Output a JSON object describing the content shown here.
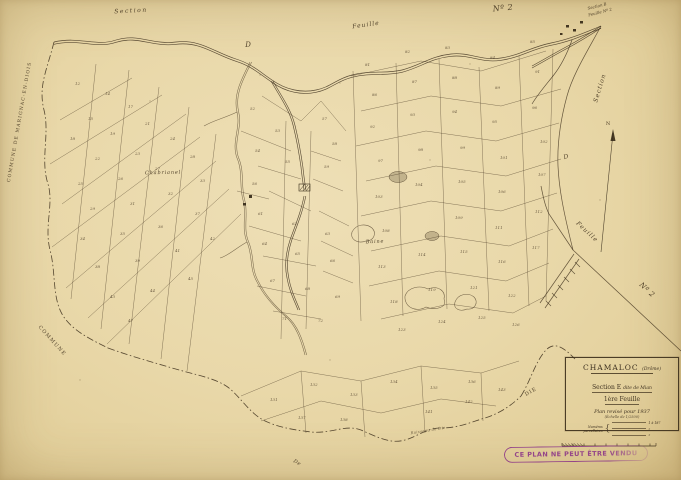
{
  "palette": {
    "paper": "#e9d8a9",
    "ink": "#43341f",
    "stamp": "#8e3a88"
  },
  "title_block": {
    "commune": "CHAMALOC",
    "departement": "(Drôme)",
    "section": "Section E",
    "section_sub": "dite de Mian",
    "sheet": "1ère Feuille",
    "revision": "Plan revisé pour 1937",
    "scale": "(Échelle de 1/2500)",
    "numbers_label_1": "Numéros",
    "numbers_label_2": "parcellaires",
    "numbers_range": "1 à 187"
  },
  "stamp_text": "CE PLAN NE PEUT ÊTRE VENDU",
  "labels": [
    {
      "name": "margin-label-section-top",
      "text": "Section",
      "x": 131,
      "y": 11,
      "rot": -3,
      "size": 6,
      "ls": 1.5,
      "it": 1
    },
    {
      "name": "margin-label-feuille-top",
      "text": "Feuille",
      "x": 366,
      "y": 25,
      "rot": -8,
      "size": 6,
      "ls": 1,
      "it": 1
    },
    {
      "name": "margin-label-d-top",
      "text": "D",
      "x": 248,
      "y": 45,
      "rot": 0,
      "size": 7,
      "ls": 0,
      "it": 1
    },
    {
      "name": "margin-label-no2-top",
      "text": "Nº 2",
      "x": 503,
      "y": 8,
      "rot": -5,
      "size": 8,
      "ls": 0.5,
      "it": 1
    },
    {
      "name": "corner-note-line1",
      "text": "Section B",
      "x": 597,
      "y": 6,
      "rot": -14,
      "size": 4,
      "ls": 0,
      "it": 1
    },
    {
      "name": "corner-note-line2",
      "text": "Feuille Nº 2",
      "x": 600,
      "y": 12,
      "rot": -14,
      "size": 4,
      "ls": 0,
      "it": 1
    },
    {
      "name": "margin-label-section-right",
      "text": "Section",
      "x": 600,
      "y": 88,
      "rot": -73,
      "size": 6,
      "ls": 1,
      "it": 1
    },
    {
      "name": "margin-label-d-right",
      "text": "D",
      "x": 566,
      "y": 157,
      "rot": -15,
      "size": 6,
      "ls": 0,
      "it": 1
    },
    {
      "name": "margin-label-feuille-right",
      "text": "Feuille",
      "x": 587,
      "y": 232,
      "rot": 43,
      "size": 6,
      "ls": 1,
      "it": 1
    },
    {
      "name": "margin-label-no2-right",
      "text": "Nº 2",
      "x": 647,
      "y": 290,
      "rot": 43,
      "size": 7,
      "ls": 0.5,
      "it": 1
    },
    {
      "name": "place-label-chabrianel",
      "text": "Chabrianel",
      "x": 163,
      "y": 173,
      "rot": -1,
      "size": 5,
      "ls": 0.8,
      "it": 1
    },
    {
      "name": "place-label-baine",
      "text": "Baine",
      "x": 375,
      "y": 242,
      "rot": -2,
      "size": 5,
      "ls": 0.8,
      "it": 1
    },
    {
      "name": "boundary-label-marignac",
      "text": "COMMUNE DE MARIGNAC-EN-DIOIS",
      "x": 20,
      "y": 122,
      "rot": -80,
      "size": 4.5,
      "ls": 1.2,
      "it": 0
    },
    {
      "name": "boundary-label-commune",
      "text": "COMMUNE",
      "x": 52,
      "y": 341,
      "rot": 48,
      "size": 5,
      "ls": 1.2,
      "it": 0
    },
    {
      "name": "boundary-label-de",
      "text": "De",
      "x": 297,
      "y": 463,
      "rot": 30,
      "size": 5,
      "ls": 0.5,
      "it": 1
    },
    {
      "name": "boundary-label-die",
      "text": "DIE",
      "x": 531,
      "y": 392,
      "rot": -30,
      "size": 5,
      "ls": 1,
      "it": 0
    },
    {
      "name": "stream-label",
      "text": "Ruisseau de Die",
      "x": 428,
      "y": 430,
      "rot": -9,
      "size": 3.8,
      "ls": 0.3,
      "it": 1,
      "op": 0.75
    },
    {
      "name": "north-arrow-label",
      "text": "N",
      "x": 608,
      "y": 124,
      "rot": 0,
      "size": 5,
      "ls": 0,
      "it": 0
    }
  ],
  "parcel_numbers": [
    {
      "x": 75,
      "y": 85,
      "t": "12"
    },
    {
      "x": 105,
      "y": 95,
      "t": "14"
    },
    {
      "x": 88,
      "y": 120,
      "t": "15"
    },
    {
      "x": 128,
      "y": 108,
      "t": "17"
    },
    {
      "x": 70,
      "y": 140,
      "t": "18"
    },
    {
      "x": 110,
      "y": 135,
      "t": "19"
    },
    {
      "x": 145,
      "y": 125,
      "t": "21"
    },
    {
      "x": 95,
      "y": 160,
      "t": "22"
    },
    {
      "x": 135,
      "y": 155,
      "t": "23"
    },
    {
      "x": 170,
      "y": 140,
      "t": "24"
    },
    {
      "x": 78,
      "y": 185,
      "t": "25"
    },
    {
      "x": 118,
      "y": 180,
      "t": "26"
    },
    {
      "x": 155,
      "y": 170,
      "t": "27"
    },
    {
      "x": 190,
      "y": 158,
      "t": "28"
    },
    {
      "x": 90,
      "y": 210,
      "t": "29"
    },
    {
      "x": 130,
      "y": 205,
      "t": "31"
    },
    {
      "x": 168,
      "y": 195,
      "t": "32"
    },
    {
      "x": 200,
      "y": 182,
      "t": "33"
    },
    {
      "x": 80,
      "y": 240,
      "t": "34"
    },
    {
      "x": 120,
      "y": 235,
      "t": "35"
    },
    {
      "x": 158,
      "y": 228,
      "t": "36"
    },
    {
      "x": 195,
      "y": 215,
      "t": "37"
    },
    {
      "x": 95,
      "y": 268,
      "t": "38"
    },
    {
      "x": 135,
      "y": 262,
      "t": "39"
    },
    {
      "x": 175,
      "y": 252,
      "t": "41"
    },
    {
      "x": 210,
      "y": 240,
      "t": "42"
    },
    {
      "x": 110,
      "y": 298,
      "t": "43"
    },
    {
      "x": 150,
      "y": 292,
      "t": "44"
    },
    {
      "x": 188,
      "y": 280,
      "t": "45"
    },
    {
      "x": 128,
      "y": 322,
      "t": "47"
    },
    {
      "x": 250,
      "y": 110,
      "t": "52"
    },
    {
      "x": 275,
      "y": 132,
      "t": "53"
    },
    {
      "x": 255,
      "y": 152,
      "t": "54"
    },
    {
      "x": 285,
      "y": 163,
      "t": "55"
    },
    {
      "x": 252,
      "y": 185,
      "t": "56"
    },
    {
      "x": 322,
      "y": 120,
      "t": "57"
    },
    {
      "x": 332,
      "y": 145,
      "t": "58"
    },
    {
      "x": 324,
      "y": 168,
      "t": "59"
    },
    {
      "x": 258,
      "y": 215,
      "t": "61"
    },
    {
      "x": 292,
      "y": 225,
      "t": "62"
    },
    {
      "x": 325,
      "y": 235,
      "t": "63"
    },
    {
      "x": 262,
      "y": 245,
      "t": "64"
    },
    {
      "x": 295,
      "y": 255,
      "t": "65"
    },
    {
      "x": 330,
      "y": 262,
      "t": "66"
    },
    {
      "x": 270,
      "y": 282,
      "t": "67"
    },
    {
      "x": 305,
      "y": 290,
      "t": "68"
    },
    {
      "x": 335,
      "y": 298,
      "t": "69"
    },
    {
      "x": 282,
      "y": 320,
      "t": "71"
    },
    {
      "x": 318,
      "y": 322,
      "t": "72"
    },
    {
      "x": 365,
      "y": 66,
      "t": "81"
    },
    {
      "x": 405,
      "y": 53,
      "t": "82"
    },
    {
      "x": 445,
      "y": 49,
      "t": "83"
    },
    {
      "x": 490,
      "y": 59,
      "t": "84"
    },
    {
      "x": 530,
      "y": 43,
      "t": "85"
    },
    {
      "x": 372,
      "y": 96,
      "t": "86"
    },
    {
      "x": 412,
      "y": 83,
      "t": "87"
    },
    {
      "x": 452,
      "y": 79,
      "t": "88"
    },
    {
      "x": 495,
      "y": 89,
      "t": "89"
    },
    {
      "x": 535,
      "y": 73,
      "t": "91"
    },
    {
      "x": 370,
      "y": 128,
      "t": "92"
    },
    {
      "x": 410,
      "y": 116,
      "t": "93"
    },
    {
      "x": 452,
      "y": 113,
      "t": "94"
    },
    {
      "x": 492,
      "y": 123,
      "t": "95"
    },
    {
      "x": 532,
      "y": 109,
      "t": "96"
    },
    {
      "x": 378,
      "y": 162,
      "t": "97"
    },
    {
      "x": 418,
      "y": 151,
      "t": "98"
    },
    {
      "x": 460,
      "y": 149,
      "t": "99"
    },
    {
      "x": 500,
      "y": 159,
      "t": "101"
    },
    {
      "x": 540,
      "y": 143,
      "t": "102"
    },
    {
      "x": 375,
      "y": 198,
      "t": "103"
    },
    {
      "x": 415,
      "y": 186,
      "t": "104"
    },
    {
      "x": 458,
      "y": 183,
      "t": "105"
    },
    {
      "x": 498,
      "y": 193,
      "t": "106"
    },
    {
      "x": 538,
      "y": 176,
      "t": "107"
    },
    {
      "x": 382,
      "y": 232,
      "t": "108"
    },
    {
      "x": 455,
      "y": 219,
      "t": "109"
    },
    {
      "x": 495,
      "y": 229,
      "t": "111"
    },
    {
      "x": 535,
      "y": 213,
      "t": "112"
    },
    {
      "x": 378,
      "y": 268,
      "t": "113"
    },
    {
      "x": 418,
      "y": 256,
      "t": "114"
    },
    {
      "x": 460,
      "y": 253,
      "t": "115"
    },
    {
      "x": 498,
      "y": 263,
      "t": "116"
    },
    {
      "x": 532,
      "y": 249,
      "t": "117"
    },
    {
      "x": 390,
      "y": 303,
      "t": "118"
    },
    {
      "x": 428,
      "y": 291,
      "t": "119"
    },
    {
      "x": 470,
      "y": 289,
      "t": "121"
    },
    {
      "x": 508,
      "y": 297,
      "t": "122"
    },
    {
      "x": 398,
      "y": 331,
      "t": "123"
    },
    {
      "x": 438,
      "y": 323,
      "t": "124"
    },
    {
      "x": 478,
      "y": 319,
      "t": "125"
    },
    {
      "x": 512,
      "y": 326,
      "t": "126"
    },
    {
      "x": 270,
      "y": 401,
      "t": "131"
    },
    {
      "x": 310,
      "y": 386,
      "t": "132"
    },
    {
      "x": 350,
      "y": 396,
      "t": "133"
    },
    {
      "x": 390,
      "y": 383,
      "t": "134"
    },
    {
      "x": 430,
      "y": 389,
      "t": "135"
    },
    {
      "x": 468,
      "y": 383,
      "t": "136"
    },
    {
      "x": 298,
      "y": 419,
      "t": "137"
    },
    {
      "x": 340,
      "y": 421,
      "t": "138"
    },
    {
      "x": 425,
      "y": 413,
      "t": "141"
    },
    {
      "x": 465,
      "y": 403,
      "t": "142"
    },
    {
      "x": 498,
      "y": 391,
      "t": "143"
    }
  ]
}
